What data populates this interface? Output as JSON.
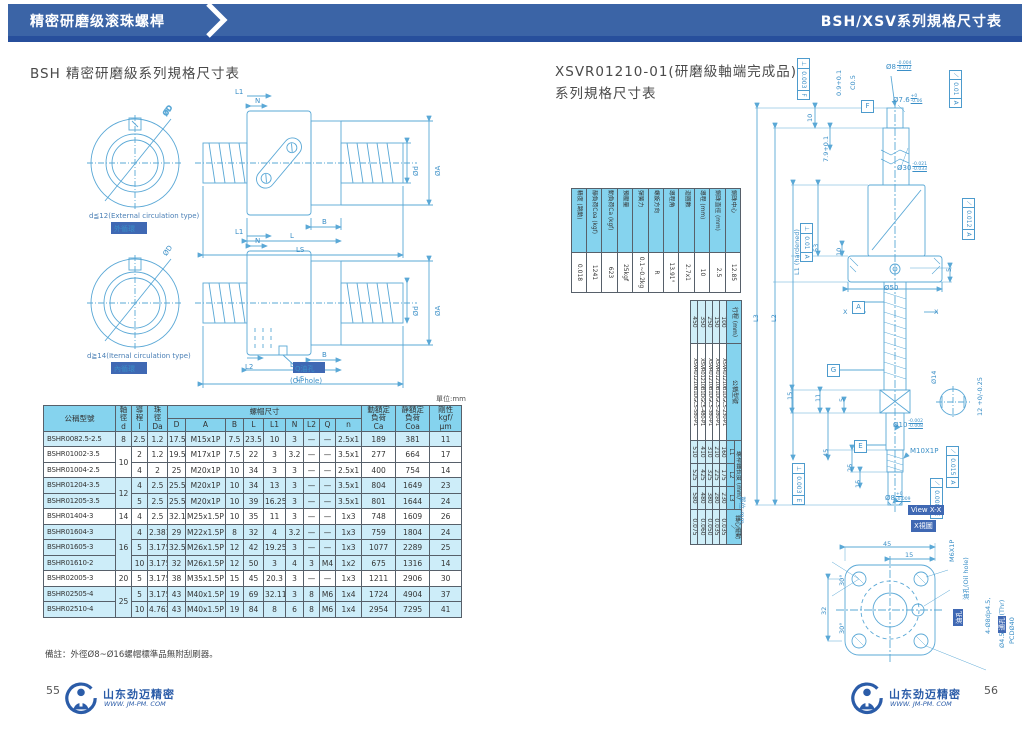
{
  "header": {
    "left_tab": "精密研磨级滚珠螺桿",
    "right_title": "BSH/XSV系列規格尺寸表"
  },
  "left_page": {
    "title": "BSH 精密研磨級系列規格尺寸表",
    "unit_note": "單位:mm",
    "diagrams": {
      "d1_caption_en": "d≦12(External circulation type)",
      "d1_caption_zh": "外循環",
      "d2_caption_en": "d≧14(Iternal circulation type)",
      "d2_caption_zh": "內循環",
      "oil_hole_zh": "Q油孔",
      "oil_hole_en": "(Oil hole)",
      "dim_od": "ØD",
      "dim_n": "N",
      "dim_l1": "L1",
      "dim_l2": "L2",
      "dim_d": "Ød",
      "dim_a": "ØA",
      "dim_b": "B",
      "dim_l": "L",
      "dim_ls": "LS"
    },
    "table": {
      "h_model": "公稱型號",
      "h_shaft": "軸\n徑\nd",
      "h_lead": "導\n程\nl",
      "h_ball": "珠\n徑\nDa",
      "h_nut": "螺帽尺寸",
      "h_sub": [
        "D",
        "A",
        "B",
        "L",
        "L1",
        "N",
        "L2",
        "Q",
        "n"
      ],
      "h_ca": "動額定\n負荷\nCa",
      "h_coa": "靜額定\n負荷\nCoa",
      "h_rig": "剛性\nkgf/\nμm",
      "rows": [
        {
          "model": "BSHR0082.5-2.5",
          "d": "8",
          "d_span": 1,
          "shade": true,
          "vals": [
            "2.5",
            "1.2",
            "17.5",
            "M15x1P",
            "7.5",
            "23.5",
            "10",
            "3",
            "—",
            "—",
            "2.5x1",
            "189",
            "381",
            "11"
          ]
        },
        {
          "model": "BSHR01002-3.5",
          "d": "10",
          "d_span": 2,
          "shade": false,
          "vals": [
            "2",
            "1.2",
            "19.5",
            "M17x1P",
            "7.5",
            "22",
            "3",
            "3.2",
            "—",
            "—",
            "3.5x1",
            "277",
            "664",
            "17"
          ]
        },
        {
          "model": "BSHR01004-2.5",
          "d": null,
          "shade": false,
          "vals": [
            "4",
            "2",
            "25",
            "M20x1P",
            "10",
            "34",
            "3",
            "3",
            "—",
            "—",
            "2.5x1",
            "400",
            "754",
            "14"
          ]
        },
        {
          "model": "BSHR01204-3.5",
          "d": "12",
          "d_span": 2,
          "shade": true,
          "vals": [
            "4",
            "2.5",
            "25.5",
            "M20x1P",
            "10",
            "34",
            "13",
            "3",
            "—",
            "—",
            "3.5x1",
            "804",
            "1649",
            "23"
          ]
        },
        {
          "model": "BSHR01205-3.5",
          "d": null,
          "shade": true,
          "vals": [
            "5",
            "2.5",
            "25.5",
            "M20x1P",
            "10",
            "39",
            "16.25",
            "3",
            "—",
            "—",
            "3.5x1",
            "801",
            "1644",
            "24"
          ]
        },
        {
          "model": "BSHR01404-3",
          "d": "14",
          "d_span": 1,
          "shade": false,
          "vals": [
            "4",
            "2.5",
            "32.1",
            "M25x1.5P",
            "10",
            "35",
            "11",
            "3",
            "—",
            "—",
            "1x3",
            "748",
            "1609",
            "26"
          ]
        },
        {
          "model": "BSHR01604-3",
          "d": "16",
          "d_span": 3,
          "shade": true,
          "vals": [
            "4",
            "2.381",
            "29",
            "M22x1.5P",
            "8",
            "32",
            "4",
            "3.2",
            "—",
            "—",
            "1x3",
            "759",
            "1804",
            "24"
          ]
        },
        {
          "model": "BSHR01605-3",
          "d": null,
          "shade": true,
          "vals": [
            "5",
            "3.175",
            "32.5",
            "M26x1.5P",
            "12",
            "42",
            "19.25",
            "3",
            "—",
            "—",
            "1x3",
            "1077",
            "2289",
            "25"
          ]
        },
        {
          "model": "BSHR01610-2",
          "d": null,
          "shade": true,
          "vals": [
            "10",
            "3.175",
            "32",
            "M26x1.5P",
            "12",
            "50",
            "3",
            "4",
            "3",
            "M4",
            "1x2",
            "675",
            "1316",
            "14"
          ]
        },
        {
          "model": "BSHR02005-3",
          "d": "20",
          "d_span": 1,
          "shade": false,
          "vals": [
            "5",
            "3.175",
            "38",
            "M35x1.5P",
            "15",
            "45",
            "20.3",
            "3",
            "—",
            "—",
            "1x3",
            "1211",
            "2906",
            "30"
          ]
        },
        {
          "model": "BSHR02505-4",
          "d": "25",
          "d_span": 2,
          "shade": true,
          "vals": [
            "5",
            "3.175",
            "43",
            "M40x1.5P",
            "19",
            "69",
            "32.11",
            "3",
            "8",
            "M6",
            "1x4",
            "1724",
            "4904",
            "37"
          ]
        },
        {
          "model": "BSHR02510-4",
          "d": null,
          "shade": true,
          "vals": [
            "10",
            "4.762",
            "43",
            "M40x1.5P",
            "19",
            "84",
            "8",
            "6",
            "8",
            "M6",
            "1x4",
            "2954",
            "7295",
            "41"
          ]
        }
      ]
    },
    "note": "備註：外徑Ø8~Ø16螺帽標準品無附刮刷器。",
    "page_number": "55"
  },
  "right_page": {
    "title_line1": "XSVR01210-01(研磨級軸端完成品)",
    "title_line2": "系列規格尺寸表",
    "unit_note": "單位:mm",
    "spec_table": {
      "rows": [
        {
          "label": "鋼珠中心",
          "value": "12.85"
        },
        {
          "label": "鋼珠直徑 (mm)",
          "value": "2.5"
        },
        {
          "label": "導程 (mm)",
          "value": "10"
        },
        {
          "label": "迴圈數",
          "value": "2.7x1"
        },
        {
          "label": "導程角",
          "value": "13.91°"
        },
        {
          "label": "螺旋方向",
          "value": "R"
        },
        {
          "label": "彈簧力",
          "value": "0.1~0.2kg"
        },
        {
          "label": "預壓量",
          "value": "25kgf"
        },
        {
          "label": "動負荷Ca (kgf)",
          "value": "623"
        },
        {
          "label": "靜負荷Coa (kgf)",
          "value": "1241"
        },
        {
          "label": "精度 (跳動)",
          "value": "0.018"
        }
      ]
    },
    "model_table": {
      "h_stroke": "行程 (mm)",
      "h_model": "公稱型號",
      "h_len": "螺桿軸長度 (mm)",
      "h_sub": [
        "L1",
        "L2",
        "L3"
      ],
      "h_runout": "軸心擺動",
      "h_runout_sym": "⟋",
      "rows": [
        {
          "stroke": "100",
          "model": "XSVR01210B1DGC5-230-P1",
          "l1": "160",
          "l2": "175",
          "l3": "230",
          "runout": "0.035"
        },
        {
          "stroke": "150",
          "model": "XSVR01210B1DGC5-280-P1",
          "l1": "210",
          "l2": "225",
          "l3": "280",
          "runout": "0.035"
        },
        {
          "stroke": "250",
          "model": "XSVR01210B1DGC5-380-P1",
          "l1": "310",
          "l2": "325",
          "l3": "380",
          "runout": "0.050"
        },
        {
          "stroke": "350",
          "model": "XSVR01210B1DGC5-480-P1",
          "l1": "410",
          "l2": "425",
          "l3": "480",
          "runout": "0.060"
        },
        {
          "stroke": "450",
          "model": "XSVR01210B1DGC5-580-P1",
          "l1": "510",
          "l2": "525",
          "l3": "580",
          "runout": "0.075"
        }
      ]
    },
    "drawing": {
      "gdt": [
        {
          "sym": "⊥",
          "val": "0.003",
          "ref": "F"
        },
        {
          "sym": "⟋",
          "val": "0.01",
          "ref": "A"
        },
        {
          "sym": "⊥",
          "val": "0.01",
          "ref": "A"
        },
        {
          "sym": "⟋",
          "val": "0.012",
          "ref": "A"
        },
        {
          "sym": "⊥",
          "val": "0.003",
          "ref": "E"
        },
        {
          "sym": "⟋",
          "val": "0.015",
          "ref": "A"
        },
        {
          "sym": "⟋",
          "val": "0.008",
          "ref": "E"
        }
      ],
      "datums": {
        "f": "F",
        "a": "A",
        "g": "G",
        "e": "E"
      },
      "dims": {
        "chamfer": "0.9+0.1",
        "c05": "C0.5",
        "ten_top": "10",
        "h79": "7.9+0.1",
        "d8top_main": "Ø8",
        "d8top_t": "-0.004",
        "d8top_b": "-0.012",
        "d76_main": "Ø7.6",
        "d76_t": "+0",
        "d76_b": "-0.06",
        "d30_main": "Ø30",
        "d30_t": "-0.021",
        "d30_b": "-0.033",
        "n53": "53",
        "l1h": "L1 (hardened)",
        "l2": "L2",
        "l3": "L3",
        "ten2": "10",
        "five1": "5",
        "d50": "Ø50",
        "x1": "X",
        "x2": "X",
        "d14": "Ø14",
        "w12": "12 +0/-0.25",
        "n15a": "15",
        "n11": "11",
        "five2": "5",
        "n45": "45",
        "n25": "25",
        "n15b": "15",
        "d10_main": "Ø10",
        "d10_t": "-0.002",
        "d10_b": "-0.008",
        "m10": "M10X1P",
        "d8b_main": "Ø8",
        "d8b_t": "+0",
        "d8b_b": "-0.009"
      },
      "view": {
        "title_en": "View X-X",
        "title_zh": "X視圖",
        "f45": "45",
        "f15": "15",
        "f32": "32",
        "a30a": "30°",
        "a30b": "30°",
        "m6": "M6X1P",
        "oil_en": "油孔(Oil hole)",
        "oil_hl": "油孔",
        "holes1": "4-Ø8dp4.5,",
        "holes2a": "Ø4.5",
        "holes2_hl": "通孔",
        "holes2b": "(Thr)",
        "holes3": "PCDØ40"
      }
    },
    "page_number": "56"
  },
  "footer": {
    "logo_text": "山东劲迈精密",
    "logo_url": "WWW. JM-PM. COM"
  }
}
